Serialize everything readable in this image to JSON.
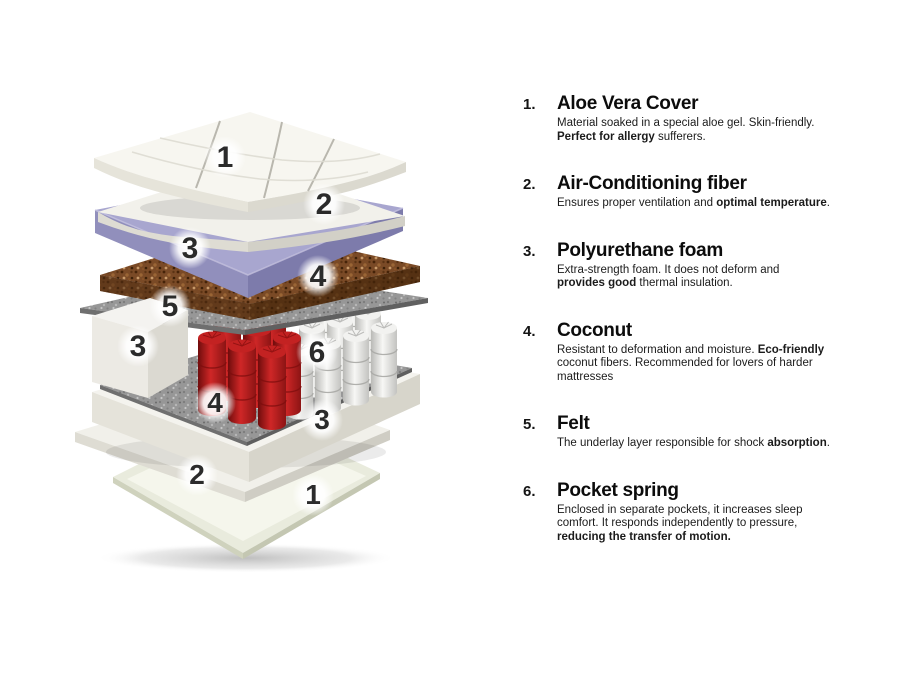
{
  "colors": {
    "purple_top": "#a8a6cf",
    "purple_side_left": "#918fbc",
    "purple_side_right": "#7d7bab",
    "coconut_base": "#7a4a26",
    "felt_base": "#979797",
    "spring_red_cap": "#c32222",
    "spring_white_cap": "#f2f2f0",
    "label_ink": "#2b2b2b"
  },
  "diagram": {
    "labels": [
      "1",
      "2",
      "3",
      "4",
      "5",
      "3",
      "6",
      "4",
      "3",
      "2",
      "1"
    ]
  },
  "legend": {
    "items": [
      {
        "number": "1.",
        "title": "Aloe Vera Cover",
        "description": [
          {
            "text": "Material soaked in a special aloe gel. Skin-friendly."
          },
          {
            "br": true
          },
          {
            "text": "Perfect for allergy",
            "bold": true
          },
          {
            "text": " sufferers."
          }
        ]
      },
      {
        "number": "2.",
        "title": "Air-Conditioning fiber",
        "description": [
          {
            "text": "Ensures proper ventilation and "
          },
          {
            "text": "optimal temperature",
            "bold": true
          },
          {
            "text": "."
          }
        ]
      },
      {
        "number": "3.",
        "title": "Polyurethane foam",
        "description": [
          {
            "text": "Extra-strength foam. It does not deform and"
          },
          {
            "br": true
          },
          {
            "text": "provides good",
            "bold": true
          },
          {
            "text": " thermal insulation."
          }
        ]
      },
      {
        "number": "4.",
        "title": "Coconut",
        "description": [
          {
            "text": "Resistant to deformation and moisture. "
          },
          {
            "text": "Eco-friendly",
            "bold": true
          },
          {
            "br": true
          },
          {
            "text": "coconut fibers. Recommended for lovers of harder"
          },
          {
            "br": true
          },
          {
            "text": "mattresses"
          }
        ]
      },
      {
        "number": "5.",
        "title": "Felt",
        "description": [
          {
            "text": "The underlay layer responsible for shock "
          },
          {
            "text": "absorption",
            "bold": true
          },
          {
            "text": "."
          }
        ]
      },
      {
        "number": "6.",
        "title": "Pocket spring",
        "description": [
          {
            "text": "Enclosed in separate pockets, it increases sleep"
          },
          {
            "br": true
          },
          {
            "text": "comfort. It responds independently to pressure,"
          },
          {
            "br": true
          },
          {
            "text": "reducing the transfer of motion.",
            "bold": true
          }
        ]
      }
    ]
  }
}
